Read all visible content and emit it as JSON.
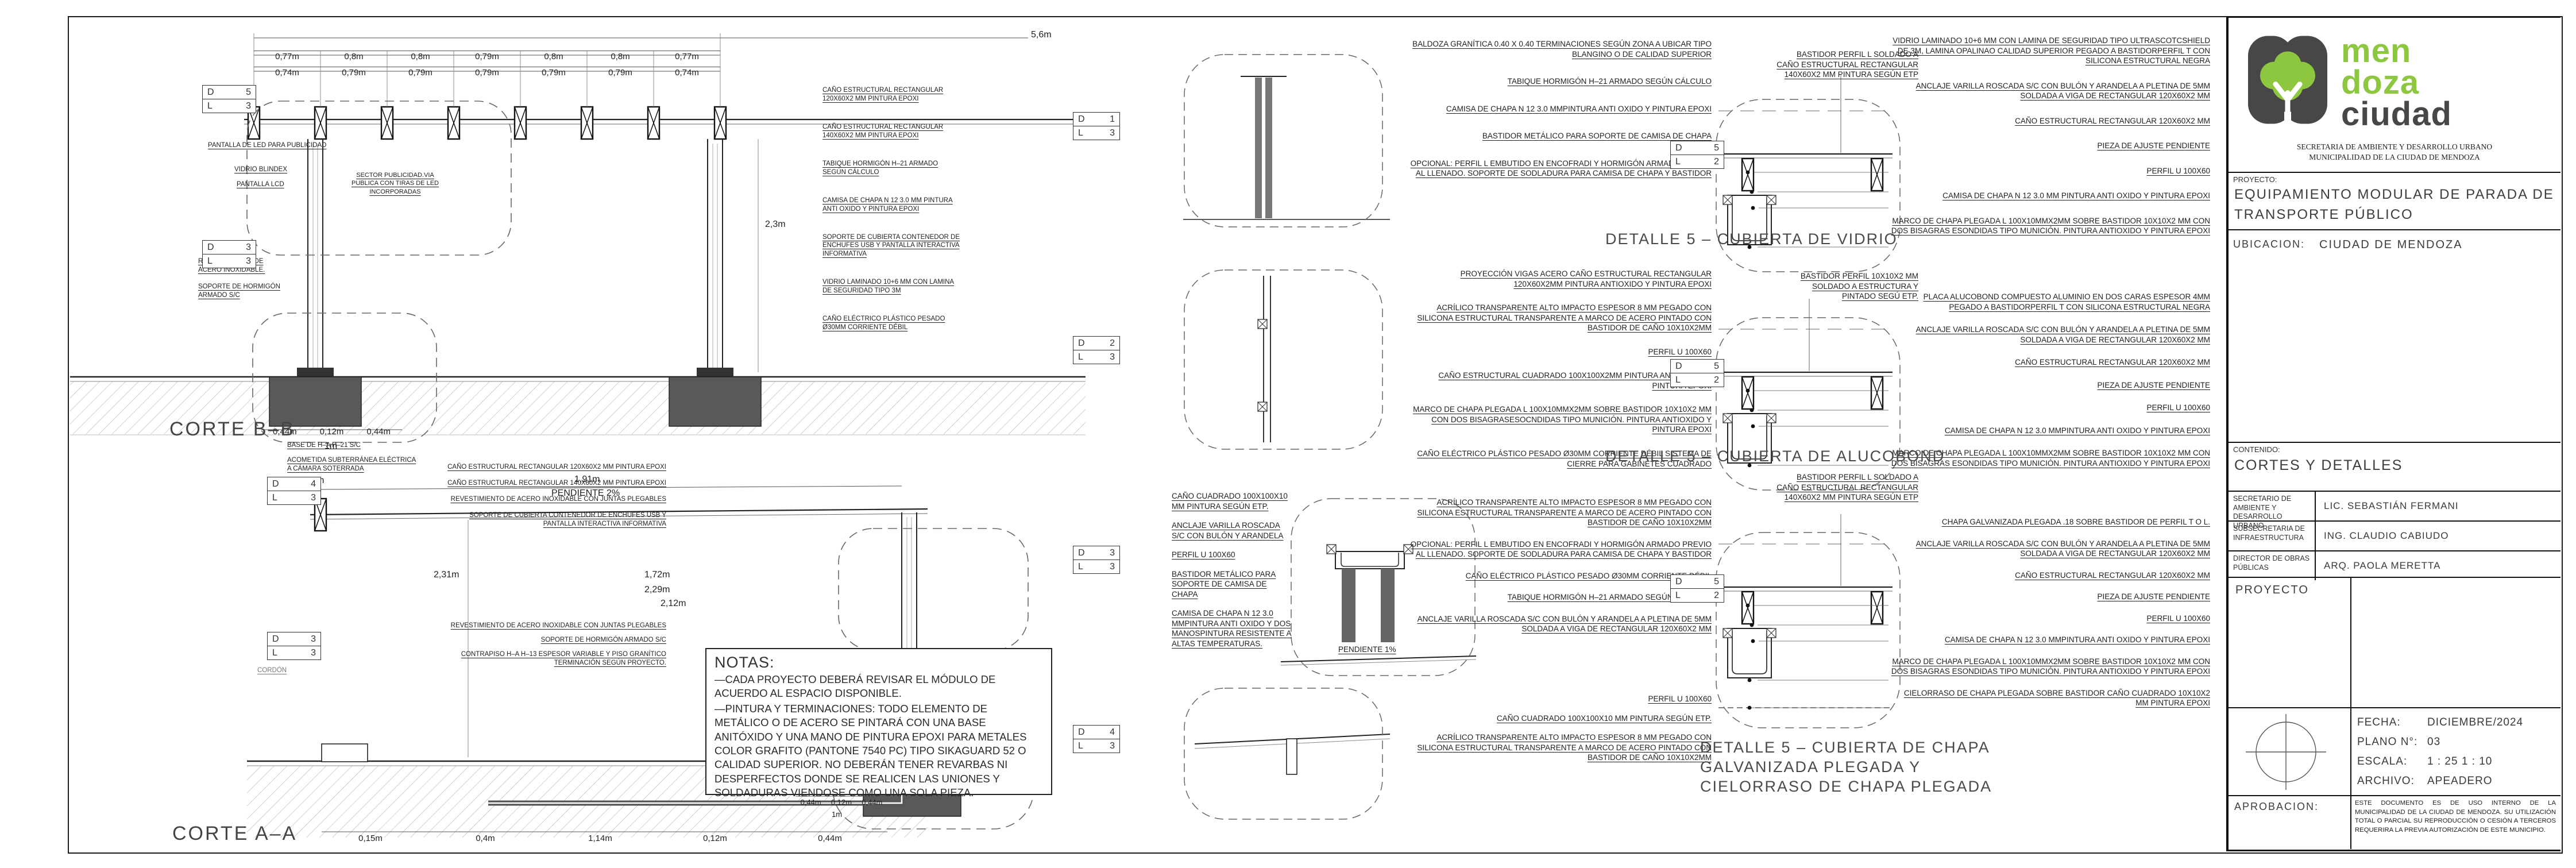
{
  "logo": {
    "word1": "men",
    "word2": "doza",
    "word3": "ciudad",
    "green": "#8dc63f",
    "dark": "#474747"
  },
  "title_block": {
    "secretaria_line1": "SECRETARIA DE AMBIENTE Y DESARROLLO URBANO",
    "secretaria_line2": "MUNICIPALIDAD DE LA CIUDAD DE MENDOZA",
    "proyecto_label": "PROYECTO:",
    "proyecto_value": "EQUIPAMIENTO MODULAR DE PARADA DE TRANSPORTE PÚBLICO",
    "ubicacion_label": "UBICACION:",
    "ubicacion_value": "CIUDAD DE MENDOZA",
    "contenido_label": "CONTENIDO:",
    "contenido_value": "CORTES Y DETALLES",
    "firmantes": [
      {
        "cargo": "SECRETARIO DE AMBIENTE Y DESARROLLO URBANO",
        "nombre": "LIC. SEBASTIÁN FERMANI"
      },
      {
        "cargo": "SUBSECRETARIA DE INFRAESTRUCTURA",
        "nombre": "ING.  CLAUDIO CABIUDO"
      },
      {
        "cargo": "DIRECTOR DE OBRAS PÚBLICAS",
        "nombre": "ARQ. PAOLA MERETTA"
      }
    ],
    "proyecto_row_label": "PROYECTO",
    "fecha_label": "FECHA:",
    "fecha_value": "DICIEMBRE/2024",
    "plano_label": "PLANO N°:",
    "plano_value": "03",
    "escala_label": "ESCALA:",
    "escala_value": "1 : 25   1 : 10",
    "archivo_label": "ARCHIVO:",
    "archivo_value": "APEADERO",
    "aprobacion_label": "APROBACION:",
    "disclaimer": "ESTE DOCUMENTO ES DE USO INTERNO DE LA MUNICIPALIDAD DE LA CIUDAD DE MENDOZA. SU UTILIZACIÓN TOTAL O PARCIAL SU REPRODUCCIÓN O CESIÓN A TERCEROS REQUERIRA LA PREVIA AUTORIZACIÓN DE ESTE MUNICIPIO."
  },
  "notas": {
    "title": "NOTAS:",
    "line1": "—CADA PROYECTO DEBERÁ REVISAR EL MÓDULO DE ACUERDO AL ESPACIO DISPONIBLE.",
    "line2": "—PINTURA Y TERMINACIONES: TODO ELEMENTO DE METÁLICO O DE ACERO SE PINTARÁ CON UNA BASE ANITÓXIDO Y UNA MANO DE PINTURA EPOXI PARA METALES COLOR GRAFITO (PANTONE 7540 PC) TIPO SIKAGUARD 52 O CALIDAD SUPERIOR. NO  DEBERÁN TENER REVARBAS NI DESPERFECTOS DONDE SE REALICEN LAS UNIONES Y SOLDADURAS VIENDOSE COMO UNA SOLA PIEZA."
  },
  "corte_bb": {
    "title": "CORTE B–B",
    "dim_total": "5,6m",
    "dims_row1": [
      "0,77m",
      "0,8m",
      "0,8m",
      "0,79m",
      "0,8m",
      "0,8m",
      "0,77m"
    ],
    "dims_row2": [
      "0,74m",
      "0,79m",
      "0,79m",
      "0,79m",
      "0,79m",
      "0,79m",
      "0,74m"
    ],
    "dim_height": "2,3m",
    "dims_base": [
      "0,44m",
      "0,12m",
      "0,44m"
    ],
    "dim_base_total": "1m",
    "labels": {
      "pantalla_led": "PANTALLA DE LED PARA PUBLICIDAD",
      "vidrio_blindex": "VIDRIO BLINDEX",
      "pantalla_lcd": "PANTALLA LCD",
      "sector_publicidad": "SECTOR PUBLICIDAD.VIA PUBLICA CON TIRAS DE LED INCORPORADAS",
      "revestimiento": "REVENTIMIENTO DE ACERO INOXIDABLE.",
      "soporte_hormigon": "SOPORTE DE HORMIGÓN ARMADO S/C"
    },
    "stack": [
      "CAÑO ESTRUCTURAL RECTANGULAR 120X60X2 MM PINTURA EPOXI",
      "CAÑO ESTRUCTURAL RECTANGULAR 140X60X2 MM PINTURA EPOXI",
      "TABIQUE HORMIGÓN H–21 ARMADO SEGÚN CÁLCULO",
      "CAMISA DE CHAPA N 12 3.0 MM PINTURA ANTI OXIDO Y PINTURA EPOXI",
      "SOPORTE DE CUBIERTA CONTENEDOR DE ENCHUFES USB Y PANTALLA INTERACTIVA INFORMATIVA",
      "VIDRIO LAMINADO 10+6 MM CON LAMINA DE SEGURIDAD TIPO 3M",
      "CAÑO ELÉCTRICO PLÁSTICO PESADO Ø30MM CORRIENTE DÉBIL"
    ]
  },
  "corte_aa": {
    "title": "CORTE A–A",
    "labels": {
      "base": "BASE DE H–A H–21 S/C",
      "acometida": "ACOMETIDA SUBTERRÁNEA ELÉCTRICA A CÁMARA SOTERRADA",
      "cordon": "CORDÓN",
      "pendiente": "PENDIENTE 2%"
    },
    "dims": {
      "d005": "0,05m",
      "d191": "1,91m",
      "d231": "2,31m",
      "d172": "1,72m",
      "d229": "2,29m",
      "d212": "2,12m",
      "base_total": "1m",
      "row_base": [
        "0,44m",
        "0,12m",
        "0,44m"
      ],
      "row_bottom": [
        "0,15m",
        "0,4m",
        "1,14m",
        "0,12m",
        "0,44m"
      ]
    },
    "stack_top": [
      "CAÑO ESTRUCTURAL RECTANGULAR 120X60X2 MM PINTURA EPOXI",
      "CAÑO ESTRUCTURAL RECTANGULAR 140X60X2 MM PINTURA EPOXI",
      "REVESTIMIENTO DE ACERO INOXIDABLE CON JUNTAS PLEGABLES",
      "SOPORTE DE CUBIERTA CONTENEDOR DE ENCHUFES USB Y PANTALLA INTERACTIVA INFORMATIVA"
    ],
    "stack_bottom": [
      "REVESTIMIENTO DE ACERO INOXIDABLE CON JUNTAS PLEGABLES",
      "SOPORTE DE HORMIGÓN ARMADO S/C",
      "CONTRAPISO H–A H–13 ESPESOR VARIABLE Y PISO GRANÍTICO TERMINACIÓN SEGÚN PROYECTO."
    ]
  },
  "middle": {
    "pendiente": "PENDIENTE 1%",
    "g1": [
      "BALDOZA GRANÍTICA 0.40 X 0.40 TERMINACIONES SEGÚN ZONA A UBICAR TIPO BLANGINO O DE CALIDAD SUPERIOR",
      "TABIQUE HORMIGÓN H–21 ARMADO SEGÚN CÁLCULO",
      "CAMISA DE CHAPA N 12 3.0 MMPINTURA ANTI OXIDO Y PINTURA EPOXI",
      "BASTIDOR METÁLICO PARA SOPORTE DE CAMISA DE CHAPA",
      "OPCIONAL: PERFIL L EMBUTIDO EN ENCOFRADI Y HORMIGÓN ARMADO PREVIO AL LLENADO. SOPORTE DE SODLADURA PARA CAMISA DE CHAPA Y BASTIDOR"
    ],
    "g2": [
      "PROYECCIÓN VIGAS ACERO CAÑO ESTRUCTURAL RECTANGULAR 120X60X2MM PINTURA ANTIOXIDO Y PINTURA EPOXI",
      "ACRÍLICO TRANSPARENTE ALTO IMPACTO ESPESOR 8 MM PEGADO CON SILICONA ESTRUCTURAL TRANSPARENTE A MARCO DE ACERO PINTADO CON BASTIDOR DE CAÑO 10X10X2MM",
      "PERFIL U 100X60",
      "CAÑO ESTRUCTURAL CUADRADO 100X100X2MM PINTURA ANTI OXIDO Y PINTURA EPOXI",
      "MARCO DE CHAPA PLEGADA L 100X10MMX2MM SOBRE BASTIDOR 10X10X2 MM CON DOS BISAGRASESOCNDIDAS TIPO MUNICIÓN. PINTURA ANTIOXIDO Y PINTURA EPOXI",
      "CAÑO ELÉCTRICO PLÁSTICO PESADO Ø30MM CORRIENTE DÉBIL SISTEMA DE CIERRE PARA GABINETES CUADRADO"
    ],
    "g3": [
      "CAÑO CUADRADO 100X100X10 MM PINTURA SEGÚN ETP.",
      "ANCLAJE VARILLA ROSCADA S/C CON BULÓN Y ARANDELA",
      "PERFIL U 100X60",
      "BASTIDOR METÁLICO PARA SOPORTE DE CAMISA DE CHAPA",
      "CAMISA DE CHAPA N 12 3.0 MMPINTURA ANTI OXIDO Y DOS MANOSPINTURA RESISTENTE A ALTAS TEMPERATURAS."
    ],
    "g4": [
      "ACRÍLICO TRANSPARENTE ALTO IMPACTO ESPESOR 8 MM PEGADO CON SILICONA ESTRUCTURAL TRANSPARENTE A MARCO DE ACERO PINTADO CON BASTIDOR DE CAÑO 10X10X2MM",
      "OPCIONAL: PERFIL L EMBUTIDO EN ENCOFRADI Y HORMIGÓN ARMADO PREVIO AL LLENADO. SOPORTE DE SODLADURA PARA CAMISA DE CHAPA Y BASTIDOR",
      "CAÑO ELÉCTRICO PLÁSTICO PESADO Ø30MM CORRIENTE DÉBIL",
      "TABIQUE HORMIGÓN H–21 ARMADO SEGÚN CÁLCULO",
      "ANCLAJE VARILLA ROSCADA S/C CON BULÓN Y ARANDELA A PLETINA DE 5MM SOLDADA A VIGA DE RECTANGULAR 120X60X2 MM"
    ],
    "g5": [
      "PERFIL U 100X60",
      "CAÑO CUADRADO 100X100X10 MM PINTURA SEGÚN ETP.",
      "ACRÍLICO TRANSPARENTE ALTO IMPACTO ESPESOR 8 MM PEGADO CON SILICONA ESTRUCTURAL TRANSPARENTE A MARCO DE ACERO PINTADO CON BASTIDOR DE CAÑO 10X10X2MM"
    ]
  },
  "detalles": [
    {
      "title": "DETALLE 5 – CUBIERTA DE VIDRIO",
      "top_label": "BASTIDOR PERFIL L SOLDADO A CAÑO ESTRUCTURAL RECTANGULAR 140X60X2 MM PINTURA SEGÚN ETP",
      "anns": [
        "VIDRIO LAMINADO 10+6 MM CON LAMINA DE SEGURIDAD TIPO ULTRASCOTCSHIELD DE 3M, LAMINA OPALINAO CALIDAD SUPERIOR PEGADO A BASTIDORPERFIL T CON SILICONA ESTRUCTURAL NEGRA",
        "ANCLAJE VARILLA ROSCADA S/C CON BULÓN Y ARANDELA A PLETINA DE 5MM SOLDADA A VIGA DE RECTANGULAR 120X60X2 MM",
        "CAÑO ESTRUCTURAL RECTANGULAR 120X60X2 MM",
        "PIEZA DE AJUSTE PENDIENTE",
        "PERFIL U 100X60",
        "CAMISA DE CHAPA N 12 3.0 MM PINTURA ANTI OXIDO Y PINTURA EPOXI",
        "MARCO DE CHAPA PLEGADA L 100X10MMX2MM SOBRE BASTIDOR 10X10X2 MM CON DOS BISAGRAS ESONDIDAS TIPO MUNICIÓN. PINTURA ANTIOXIDO Y PINTURA EPOXI"
      ]
    },
    {
      "title": "DETALLE 5 – CUBIERTA DE ALUCOBOND",
      "top_label": "BASTIDOR PERFIL 10X10X2 MM SOLDADO A ESTRUCTURA Y PINTADO SEGÚ ETP.",
      "anns": [
        "PLACA ALUCOBOND COMPUESTO ALUMINIO EN DOS CARAS ESPESOR 4MM PEGADO A BASTIDORPERFIL T CON SILICONA ESTRUCTURAL NEGRA",
        "ANCLAJE VARILLA ROSCADA S/C CON BULÓN Y ARANDELA A PLETINA DE 5MM SOLDADA A VIGA DE RECTANGULAR 120X60X2 MM",
        "CAÑO ESTRUCTURAL RECTANGULAR 120X60X2 MM",
        "PIEZA DE AJUSTE PENDIENTE",
        "PERFIL U 100X60",
        "CAMISA DE CHAPA N 12 3.0 MMPINTURA ANTI OXIDO Y PINTURA EPOXI",
        "MARCO DE CHAPA PLEGADA L 100X10MMX2MM SOBRE BASTIDOR 10X10X2 MM CON DOS BISAGRAS ESONDIDAS TIPO MUNICIÓN. PINTURA ANTIOXIDO Y PINTURA EPOXI"
      ]
    },
    {
      "title": "DETALLE 5 – CUBIERTA DE CHAPA GALVANIZADA PLEGADA Y CIELORRASO DE CHAPA PLEGADA",
      "top_label": "BASTIDOR PERFIL L SOLDADO A CAÑO ESTRUCTURAL RECTANGULAR 140X60X2 MM PINTURA SEGÚN ETP",
      "anns": [
        "CHAPA GALVANIZADA PLEGADA .18 SOBRE BASTIDOR DE PERFIL T O L.",
        "ANCLAJE VARILLA ROSCADA S/C CON BULÓN Y ARANDELA A PLETINA DE 5MM SOLDADA A VIGA DE RECTANGULAR 120X60X2 MM",
        "CAÑO ESTRUCTURAL RECTANGULAR 120X60X2 MM",
        "PIEZA DE AJUSTE PENDIENTE",
        "PERFIL U 100X60",
        "CAMISA DE CHAPA N 12 3.0 MMPINTURA ANTI OXIDO Y PINTURA EPOXI",
        "MARCO DE CHAPA PLEGADA L 100X10MMX2MM SOBRE BASTIDOR 10X10X2 MM CON DOS BISAGRAS ESONDIDAS TIPO MUNICIÓN. PINTURA ANTIOXIDO Y PINTURA EPOXI",
        "CIELORRASO DE CHAPA PLEGADA SOBRE BASTIDOR CAÑO CUADRADO 10X10X2 MM PINTURA EPOXI"
      ]
    }
  ],
  "bubbles": [
    {
      "d": "D",
      "dn": "5",
      "l": "L",
      "ln": "3"
    },
    {
      "d": "D",
      "dn": "3",
      "l": "L",
      "ln": "3"
    },
    {
      "d": "D",
      "dn": "4",
      "l": "L",
      "ln": "3"
    },
    {
      "d": "D",
      "dn": "3",
      "l": "L",
      "ln": "3"
    },
    {
      "d": "D",
      "dn": "1",
      "l": "L",
      "ln": "3"
    },
    {
      "d": "D",
      "dn": "2",
      "l": "L",
      "ln": "3"
    },
    {
      "d": "D",
      "dn": "3",
      "l": "L",
      "ln": "3"
    },
    {
      "d": "D",
      "dn": "4",
      "l": "L",
      "ln": "3"
    },
    {
      "d": "D",
      "dn": "5",
      "l": "L",
      "ln": "2"
    },
    {
      "d": "D",
      "dn": "5",
      "l": "L",
      "ln": "2"
    },
    {
      "d": "D",
      "dn": "5",
      "l": "L",
      "ln": "2"
    }
  ]
}
